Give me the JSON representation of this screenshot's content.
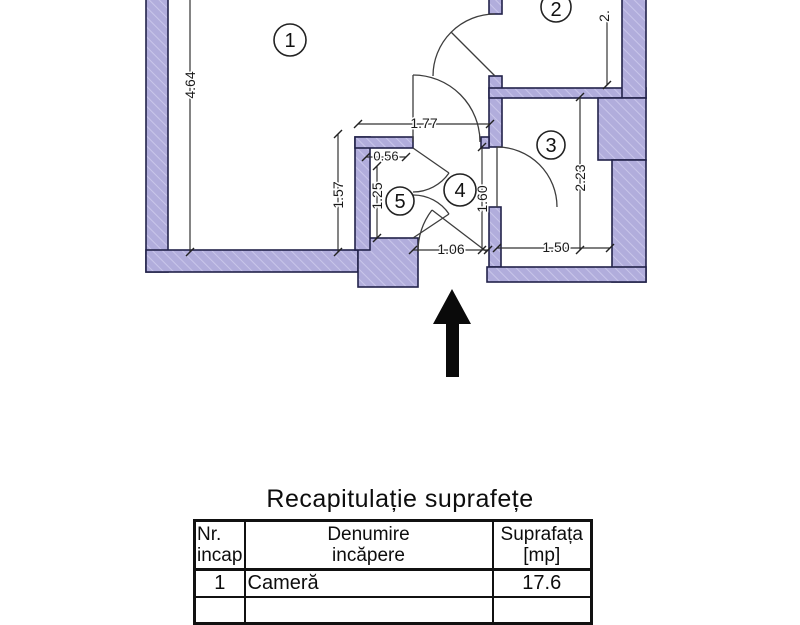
{
  "plan": {
    "wall_fill_color": "#b1addc",
    "wall_outline_color": "#22224a",
    "rooms": [
      {
        "number": "1"
      },
      {
        "number": "2"
      },
      {
        "number": "3"
      },
      {
        "number": "4"
      },
      {
        "number": "5"
      }
    ],
    "dimensions": [
      {
        "label": "4.64"
      },
      {
        "label": "1.77"
      },
      {
        "label": "0.56"
      },
      {
        "label": "1.57"
      },
      {
        "label": "1.25"
      },
      {
        "label": "1.60"
      },
      {
        "label": "2.23"
      },
      {
        "label": "1.50"
      },
      {
        "label": "1.06"
      },
      {
        "label": "2."
      }
    ]
  },
  "table": {
    "title": "Recapitulație suprafețe",
    "headers": {
      "col1_line1": "Nr.",
      "col1_line2": "incap.",
      "col2_line1": "Denumire",
      "col2_line2": "incăpere",
      "col3_line1": "Suprafața",
      "col3_line2": "[mp]"
    },
    "rows": [
      {
        "nr": "1",
        "name": "Cameră",
        "area": "17.6"
      }
    ]
  }
}
